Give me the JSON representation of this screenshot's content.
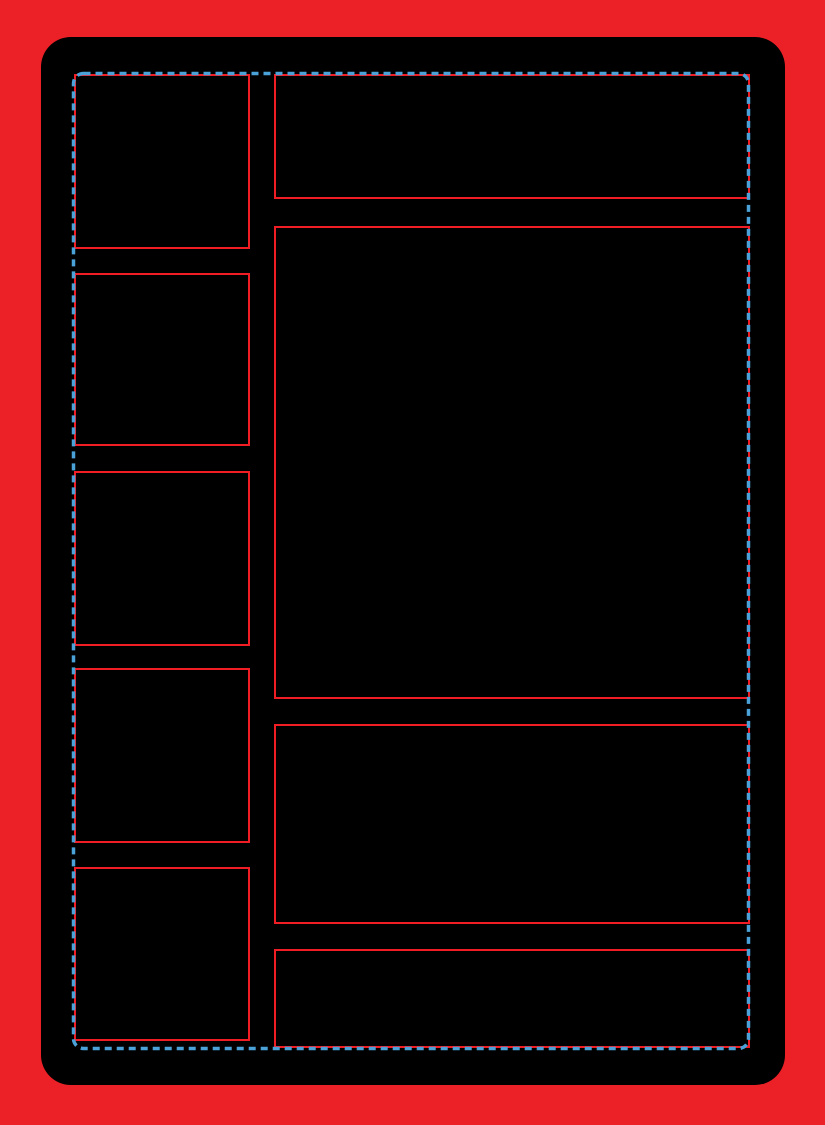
{
  "template": {
    "name": "blank-comic-page-layout-template",
    "description": "Black rounded page on red background with empty red-outlined panels and a blue dashed trim guide. No visible text.",
    "colors": {
      "background_red": "#EC2127",
      "panel_outline_red": "#F01D24",
      "bleed_dash_blue": "#4AA2D9",
      "page_black": "#000000"
    },
    "guide": {
      "style": "dashed",
      "dash_length_px": 7,
      "dash_gap_px": 5,
      "stroke_width_px": 3.5
    },
    "panels": {
      "left_column": [
        "left-panel-1",
        "left-panel-2",
        "left-panel-3",
        "left-panel-4",
        "left-panel-5"
      ],
      "right_column": [
        "right-panel-1",
        "right-panel-2",
        "right-panel-3",
        "right-panel-4"
      ]
    }
  }
}
